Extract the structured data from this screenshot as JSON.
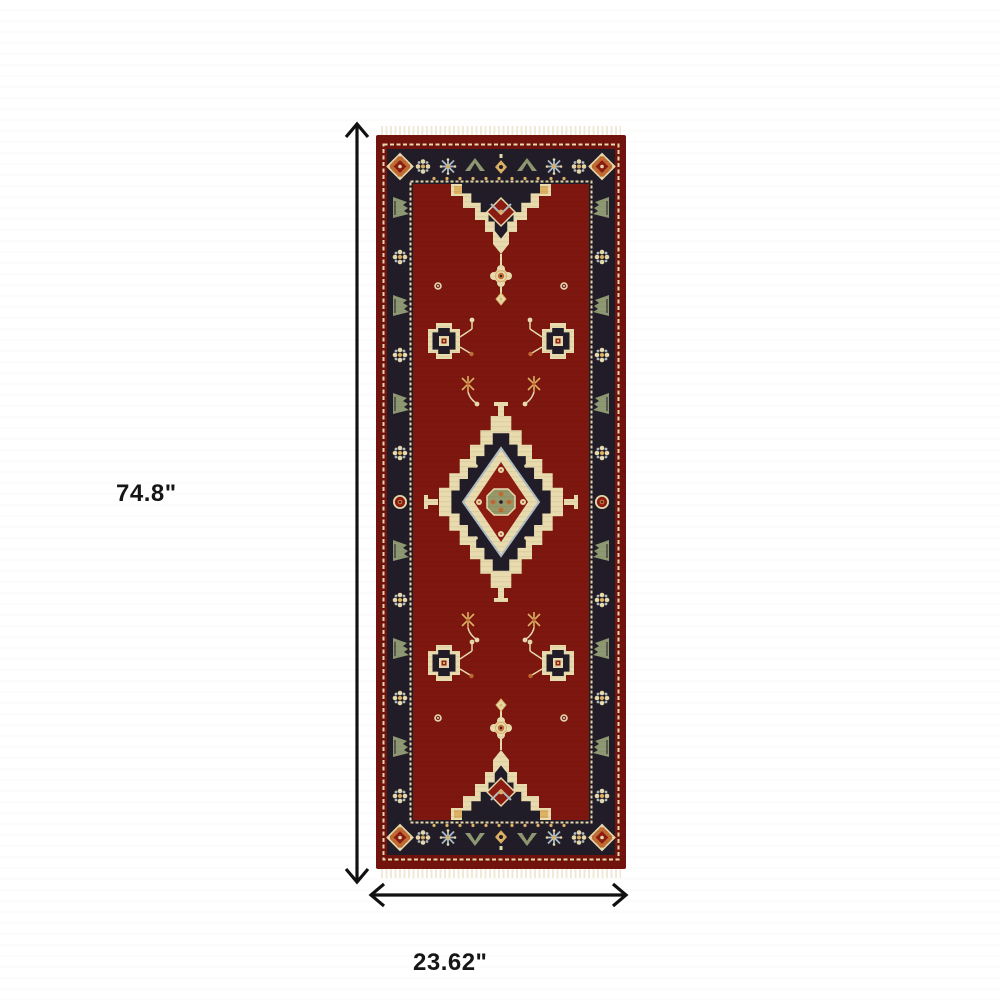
{
  "meta": {
    "alt": "Red and navy oriental runner rug with triple medallion pattern, cream fringe, shown with dimension arrows"
  },
  "dimensions": {
    "height_label": "74.8\"",
    "width_label": "23.62\""
  },
  "colors": {
    "page-bg": "#ffffff",
    "arrow": "#111111",
    "label": "#161616",
    "edge-red": "#72130d",
    "field-red": "#7d170f",
    "band-navy": "#211d28",
    "cream": "#e8dbae",
    "fringe": "#f0e9d8",
    "sage": "#8e9973",
    "blue": "#b0bdc5",
    "rust": "#c06b33",
    "gold": "#ddb264",
    "deep-red": "#8c1c12",
    "olive": "#96986a"
  }
}
